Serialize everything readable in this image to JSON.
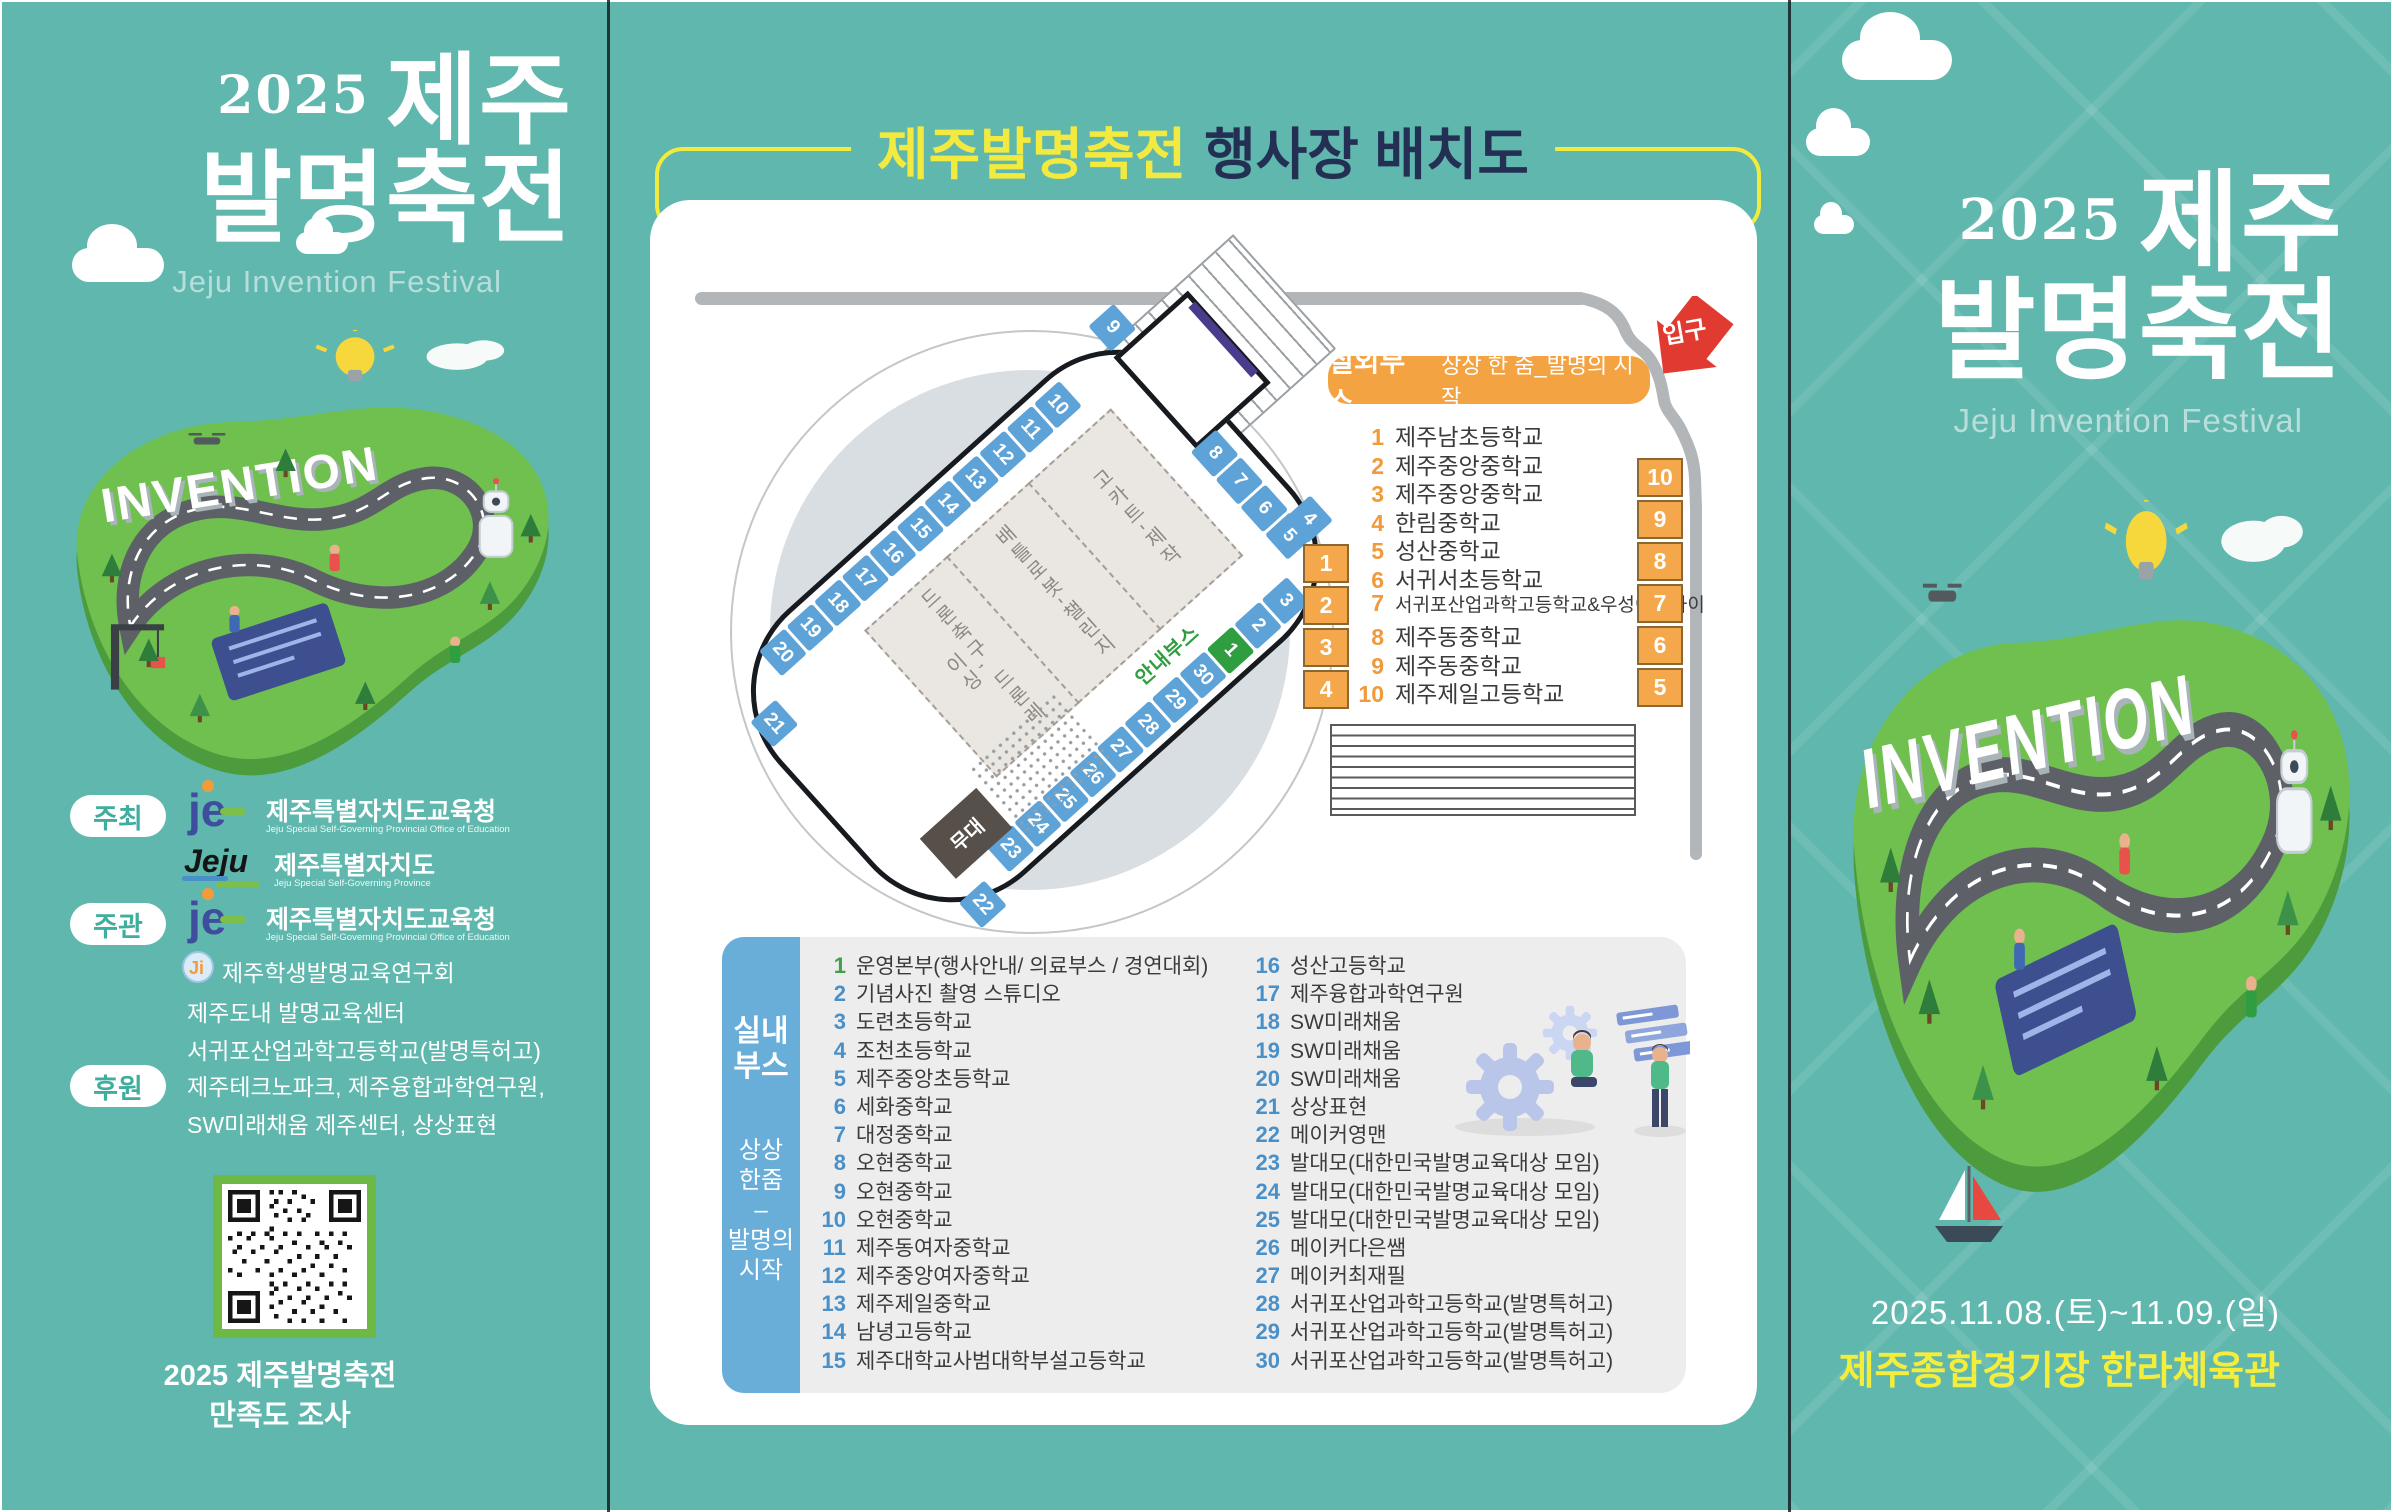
{
  "colors": {
    "teal": "#5FB7AE",
    "yellow": "#F2EA3F",
    "orange": "#F4A342",
    "booth_blue": "#5EA3D8",
    "booth_green": "#2F9E41",
    "entrance_red": "#E13A30",
    "sidebar_blue": "#69AED9",
    "number_blue": "#4A90C8",
    "qr_green": "#6CB945",
    "title_navy": "#243053"
  },
  "left_panel": {
    "year": "2025",
    "title_line1": "제주",
    "title_line2": "발명축전",
    "subtitle": "Jeju Invention Festival",
    "island_label": "INVENTION",
    "host_label": "주최",
    "host_org1_name": "제주특별자치도교육청",
    "host_org1_eng": "Jeju Special Self-Governing Provincial Office of Education",
    "host_org2_name": "제주특별자치도",
    "host_org2_eng": "Jeju Special Self-Governing Province",
    "organizer_label": "주관",
    "organizer_org1_name": "제주특별자치도교육청",
    "organizer_org1_eng": "Jeju Special Self-Governing Provincial Office of Education",
    "organizer_lines": [
      "제주학생발명교육연구회",
      "제주도내 발명교육센터",
      "서귀포산업과학고등학교(발명특허고)"
    ],
    "sponsor_label": "후원",
    "sponsor_lines": [
      "제주테크노파크, 제주융합과학연구원,",
      "SW미래채움 제주센터, 상상표현"
    ],
    "je_logo_text": "je",
    "jeju_logo_text": "Jeju",
    "ji_logo_text": "Ji",
    "qr_caption1": "2025 제주발명축전",
    "qr_caption2": "만족도 조사"
  },
  "middle_panel": {
    "title_highlight": "제주발명축전",
    "title_rest": "행사장 배치도",
    "map": {
      "entrance_label": "입구",
      "stage_label": "무대",
      "info_label": "안내부스",
      "zones": [
        "드론축구, 드론레이싱",
        "배틀로봇-챌린지",
        "고카트-제작"
      ],
      "top_row": [
        "20",
        "19",
        "18",
        "17",
        "16",
        "15",
        "14",
        "13",
        "12",
        "11",
        "10"
      ],
      "right_col": [
        "8",
        "7",
        "6",
        "5"
      ],
      "bottom_row": [
        "23",
        "24",
        "25",
        "26",
        "27",
        "28",
        "29",
        "30",
        "1",
        "2",
        "3"
      ],
      "corner_tl": "21",
      "corner_tr": "9",
      "corner_bl": "22",
      "corner_br": "4"
    },
    "outdoor": {
      "title": "실외부스",
      "subtitle": "상상 한 줌_발명의 시작",
      "items": [
        {
          "num": "1",
          "name": "제주남초등학교"
        },
        {
          "num": "2",
          "name": "제주중앙중학교"
        },
        {
          "num": "3",
          "name": "제주중앙중학교"
        },
        {
          "num": "4",
          "name": "한림중학교"
        },
        {
          "num": "5",
          "name": "성산중학교"
        },
        {
          "num": "6",
          "name": "서귀서초등학교"
        },
        {
          "num": "7",
          "name": "서귀포산업과학고등학교&우성이앤아이"
        },
        {
          "num": "8",
          "name": "제주동중학교"
        },
        {
          "num": "9",
          "name": "제주동중학교"
        },
        {
          "num": "10",
          "name": "제주제일고등학교"
        }
      ],
      "left_boxes": [
        "1",
        "2",
        "3",
        "4"
      ],
      "right_boxes": [
        "10",
        "9",
        "8",
        "7",
        "6",
        "5"
      ]
    },
    "indoor": {
      "sidebar_title1": "실내",
      "sidebar_title2": "부스",
      "sidebar_sub1": "상상",
      "sidebar_sub2": "한줌",
      "sidebar_dash": "–",
      "sidebar_sub3": "발명의",
      "sidebar_sub4": "시작",
      "items": [
        {
          "num": "1",
          "name": "운영본부(행사안내/ 의료부스 / 경연대회)"
        },
        {
          "num": "2",
          "name": "기념사진 촬영 스튜디오"
        },
        {
          "num": "3",
          "name": "도련초등학교"
        },
        {
          "num": "4",
          "name": "조천초등학교"
        },
        {
          "num": "5",
          "name": "제주중앙초등학교"
        },
        {
          "num": "6",
          "name": "세화중학교"
        },
        {
          "num": "7",
          "name": "대정중학교"
        },
        {
          "num": "8",
          "name": "오현중학교"
        },
        {
          "num": "9",
          "name": "오현중학교"
        },
        {
          "num": "10",
          "name": "오현중학교"
        },
        {
          "num": "11",
          "name": "제주동여자중학교"
        },
        {
          "num": "12",
          "name": "제주중앙여자중학교"
        },
        {
          "num": "13",
          "name": "제주제일중학교"
        },
        {
          "num": "14",
          "name": "남녕고등학교"
        },
        {
          "num": "15",
          "name": "제주대학교사범대학부설고등학교"
        },
        {
          "num": "16",
          "name": "성산고등학교"
        },
        {
          "num": "17",
          "name": "제주융합과학연구원"
        },
        {
          "num": "18",
          "name": "SW미래채움"
        },
        {
          "num": "19",
          "name": "SW미래채움"
        },
        {
          "num": "20",
          "name": "SW미래채움"
        },
        {
          "num": "21",
          "name": "상상표현"
        },
        {
          "num": "22",
          "name": "메이커영맨"
        },
        {
          "num": "23",
          "name": "발대모(대한민국발명교육대상 모임)"
        },
        {
          "num": "24",
          "name": "발대모(대한민국발명교육대상 모임)"
        },
        {
          "num": "25",
          "name": "발대모(대한민국발명교육대상 모임)"
        },
        {
          "num": "26",
          "name": "메이커다은쌤"
        },
        {
          "num": "27",
          "name": "메이커최재필"
        },
        {
          "num": "28",
          "name": "서귀포산업과학고등학교(발명특허고)"
        },
        {
          "num": "29",
          "name": "서귀포산업과학고등학교(발명특허고)"
        },
        {
          "num": "30",
          "name": "서귀포산업과학고등학교(발명특허고)"
        }
      ]
    }
  },
  "right_panel": {
    "year": "2025",
    "title_line1": "제주",
    "title_line2": "발명축전",
    "subtitle": "Jeju Invention Festival",
    "island_label": "INVENTION",
    "date_line": "2025.11.08.(토)~11.09.(일)",
    "venue_line": "제주종합경기장 한라체육관"
  }
}
